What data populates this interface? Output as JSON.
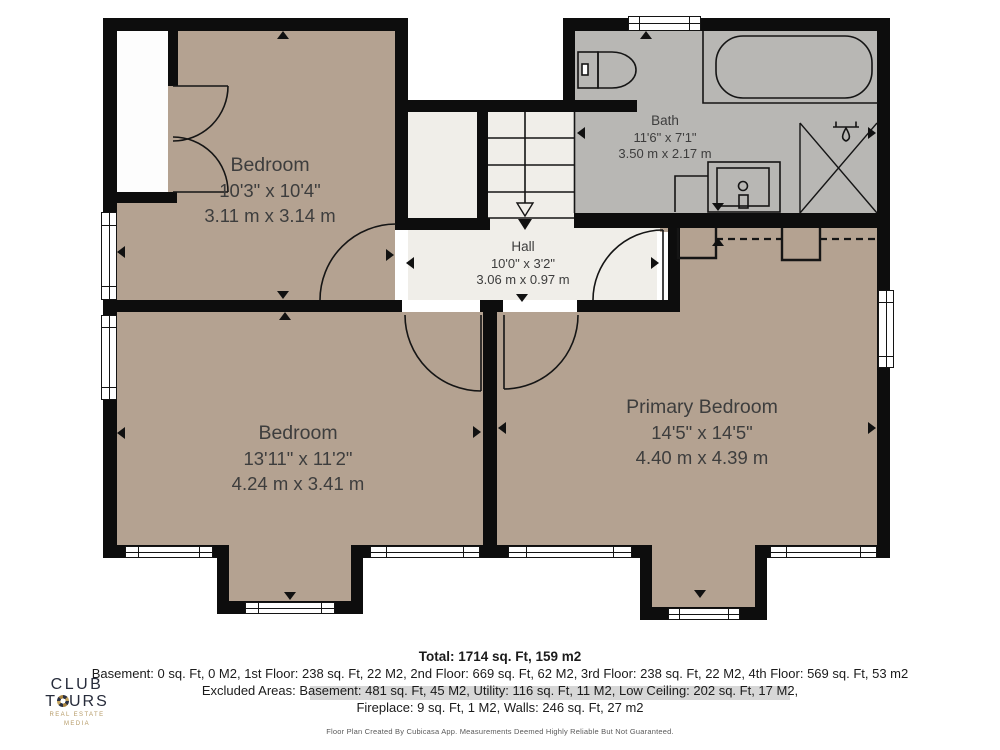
{
  "plan": {
    "rooms": [
      {
        "id": "bedroom-1",
        "name": "Bedroom",
        "dim_imperial": "10'3\" x 10'4\"",
        "dim_metric": "3.11 m x 3.14 m"
      },
      {
        "id": "bath",
        "name": "Bath",
        "dim_imperial": "11'6\" x 7'1\"",
        "dim_metric": "3.50 m x 2.17 m"
      },
      {
        "id": "hall",
        "name": "Hall",
        "dim_imperial": "10'0\" x 3'2\"",
        "dim_metric": "3.06 m x 0.97 m"
      },
      {
        "id": "bedroom-2",
        "name": "Bedroom",
        "dim_imperial": "13'11\" x 11'2\"",
        "dim_metric": "4.24 m x 3.41 m"
      },
      {
        "id": "primary-bedroom",
        "name": "Primary Bedroom",
        "dim_imperial": "14'5\" x 14'5\"",
        "dim_metric": "4.40 m x 4.39 m"
      }
    ],
    "colors": {
      "wall": "#0d0d0d",
      "room_tan": "#b4a291",
      "room_gray": "#b8b7b4",
      "room_light": "#f0eee9",
      "window": "#ffffff"
    }
  },
  "summary": {
    "total": "Total: 1714 sq. Ft, 159 m2",
    "floors": "Basement: 0 sq. Ft, 0 M2, 1st Floor: 238 sq. Ft, 22 M2, 2nd Floor: 669 sq. Ft, 62 M2, 3rd Floor: 238 sq. Ft, 22 M2, 4th Floor: 569 sq. Ft, 53 m2",
    "excluded_line1": "Excluded Areas: Basement: 481 sq. Ft, 45 M2, Utility: 116 sq. Ft, 11 M2, Low Ceiling: 202 sq. Ft, 17 M2,",
    "excluded_line2": "Fireplace: 9 sq. Ft, 1 M2, Walls: 246 sq. Ft, 27 m2",
    "disclaimer": "Floor Plan Created By Cubicasa App. Measurements Deemed Highly Reliable But Not Guaranteed."
  },
  "logo": {
    "line1": "CLUB",
    "line2_prefix": "T",
    "line2_suffix": "URS",
    "tagline": "REAL ESTATE MEDIA"
  }
}
